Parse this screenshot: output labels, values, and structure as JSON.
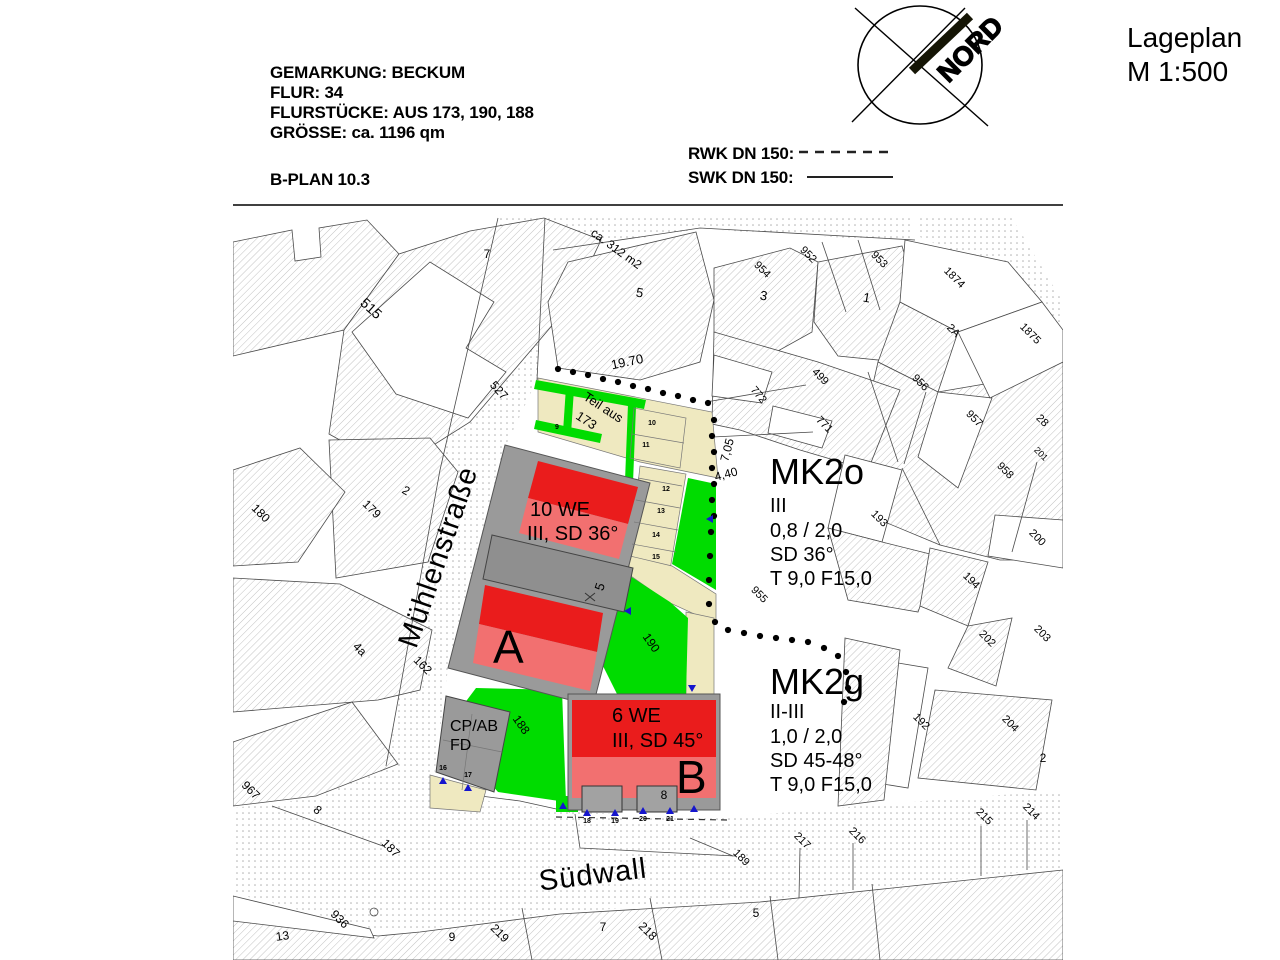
{
  "title": {
    "line1": "Lageplan",
    "line2": "M 1:500"
  },
  "header": {
    "lines": [
      "GEMARKUNG: BECKUM",
      "FLUR: 34",
      "FLURSTÜCKE: AUS 173, 190, 188",
      "GRÖSSE: ca. 1196 qm"
    ],
    "bplan": "B-PLAN 10.3"
  },
  "legend": {
    "rwk_label": "RWK DN 150:",
    "swk_label": "SWK DN 150:"
  },
  "north": {
    "label": "NORD"
  },
  "zones": {
    "mk2o": {
      "name": "MK2o",
      "lines": [
        "III",
        "0,8 / 2,0",
        "SD 36°",
        "T 9,0 F15,0"
      ]
    },
    "mk2g": {
      "name": "MK2g",
      "lines": [
        "II-III",
        "1,0 / 2,0",
        "SD 45-48°",
        "T 9,0 F15,0"
      ]
    }
  },
  "buildings": {
    "a": {
      "label": "A",
      "info1": "10 WE",
      "info2": "III, SD 36°"
    },
    "b": {
      "label": "B",
      "info1": "6 WE",
      "info2": "III, SD 45°"
    },
    "cp": {
      "line1": "CP/AB",
      "line2": "FD"
    }
  },
  "streets": {
    "west": "Mühlenstraße",
    "south": "Südwall"
  },
  "colors": {
    "roof_dark": "#ea1c1c",
    "roof_light": "#f27070",
    "lawn_green": "#00dc00",
    "path_beige": "#efe9c0",
    "building_gray": "#9a9a9a",
    "marker_blue": "#1515cd"
  },
  "map_labels": [
    {
      "t": "515",
      "x": 368,
      "y": 312,
      "r": 42,
      "s": 14
    },
    {
      "t": "7",
      "x": 487,
      "y": 258,
      "r": 0,
      "s": 12
    },
    {
      "t": "527",
      "x": 496,
      "y": 393,
      "r": 48,
      "s": 12
    },
    {
      "t": "2",
      "x": 404,
      "y": 494,
      "r": 30,
      "s": 12
    },
    {
      "t": "179",
      "x": 369,
      "y": 512,
      "r": 45,
      "s": 12
    },
    {
      "t": "180",
      "x": 258,
      "y": 516,
      "r": 45,
      "s": 12
    },
    {
      "t": "4a",
      "x": 357,
      "y": 652,
      "r": 45,
      "s": 12
    },
    {
      "t": "162",
      "x": 420,
      "y": 668,
      "r": 45,
      "s": 12
    },
    {
      "t": "967",
      "x": 248,
      "y": 793,
      "r": 45,
      "s": 12
    },
    {
      "t": "8",
      "x": 315,
      "y": 813,
      "r": 40,
      "s": 12
    },
    {
      "t": "187",
      "x": 388,
      "y": 851,
      "r": 45,
      "s": 12
    },
    {
      "t": "936",
      "x": 337,
      "y": 922,
      "r": 45,
      "s": 12
    },
    {
      "t": "13",
      "x": 283,
      "y": 940,
      "r": -8,
      "s": 12
    },
    {
      "t": "9",
      "x": 452,
      "y": 941,
      "r": 0,
      "s": 12
    },
    {
      "t": "219",
      "x": 497,
      "y": 936,
      "r": 45,
      "s": 12
    },
    {
      "t": "7",
      "x": 603,
      "y": 931,
      "r": 0,
      "s": 12
    },
    {
      "t": "218",
      "x": 645,
      "y": 934,
      "r": 45,
      "s": 12
    },
    {
      "t": "5",
      "x": 756,
      "y": 917,
      "r": 0,
      "s": 12
    },
    {
      "t": "ca. 312 m2",
      "x": 614,
      "y": 252,
      "r": 36,
      "s": 12
    },
    {
      "t": "5",
      "x": 639,
      "y": 297,
      "r": 10,
      "s": 13
    },
    {
      "t": "3",
      "x": 763,
      "y": 300,
      "r": 10,
      "s": 13
    },
    {
      "t": "1",
      "x": 866,
      "y": 302,
      "r": 10,
      "s": 13
    },
    {
      "t": "954",
      "x": 760,
      "y": 272,
      "r": 45,
      "s": 11
    },
    {
      "t": "952",
      "x": 806,
      "y": 257,
      "r": 45,
      "s": 11
    },
    {
      "t": "953",
      "x": 877,
      "y": 262,
      "r": 45,
      "s": 11
    },
    {
      "t": "499",
      "x": 818,
      "y": 379,
      "r": 45,
      "s": 11
    },
    {
      "t": "772",
      "x": 756,
      "y": 397,
      "r": 50,
      "s": 11
    },
    {
      "t": "771",
      "x": 822,
      "y": 427,
      "r": 45,
      "s": 11
    },
    {
      "t": "1874",
      "x": 952,
      "y": 280,
      "r": 45,
      "s": 11
    },
    {
      "t": "2A",
      "x": 951,
      "y": 333,
      "r": 45,
      "s": 11
    },
    {
      "t": "1875",
      "x": 1028,
      "y": 336,
      "r": 45,
      "s": 11
    },
    {
      "t": "956",
      "x": 918,
      "y": 385,
      "r": 45,
      "s": 11
    },
    {
      "t": "957",
      "x": 972,
      "y": 421,
      "r": 45,
      "s": 11
    },
    {
      "t": "28",
      "x": 1040,
      "y": 423,
      "r": 45,
      "s": 11
    },
    {
      "t": "201",
      "x": 1039,
      "y": 456,
      "r": 45,
      "s": 9
    },
    {
      "t": "958",
      "x": 1003,
      "y": 473,
      "r": 45,
      "s": 11
    },
    {
      "t": "200",
      "x": 1035,
      "y": 540,
      "r": 45,
      "s": 11
    },
    {
      "t": "193",
      "x": 877,
      "y": 521,
      "r": 45,
      "s": 11
    },
    {
      "t": "955",
      "x": 757,
      "y": 597,
      "r": 45,
      "s": 11
    },
    {
      "t": "194",
      "x": 969,
      "y": 583,
      "r": 45,
      "s": 11
    },
    {
      "t": "202",
      "x": 985,
      "y": 641,
      "r": 45,
      "s": 11
    },
    {
      "t": "203",
      "x": 1040,
      "y": 636,
      "r": 45,
      "s": 11
    },
    {
      "t": "192",
      "x": 919,
      "y": 724,
      "r": 45,
      "s": 11
    },
    {
      "t": "204",
      "x": 1008,
      "y": 726,
      "r": 45,
      "s": 11
    },
    {
      "t": "2",
      "x": 1043,
      "y": 762,
      "r": 0,
      "s": 12
    },
    {
      "t": "215",
      "x": 982,
      "y": 819,
      "r": 45,
      "s": 11
    },
    {
      "t": "214",
      "x": 1029,
      "y": 814,
      "r": 45,
      "s": 11
    },
    {
      "t": "216",
      "x": 855,
      "y": 838,
      "r": 45,
      "s": 11
    },
    {
      "t": "217",
      "x": 800,
      "y": 843,
      "r": 45,
      "s": 11
    },
    {
      "t": "189",
      "x": 739,
      "y": 860,
      "r": 45,
      "s": 11
    },
    {
      "t": "190",
      "x": 648,
      "y": 645,
      "r": 55,
      "s": 12
    },
    {
      "t": "188",
      "x": 518,
      "y": 727,
      "r": 55,
      "s": 12
    },
    {
      "t": "Teil aus",
      "x": 601,
      "y": 411,
      "r": 33,
      "s": 13
    },
    {
      "t": "173",
      "x": 584,
      "y": 424,
      "r": 33,
      "s": 13
    },
    {
      "t": "19.70",
      "x": 628,
      "y": 366,
      "r": -12,
      "s": 13
    },
    {
      "t": "7,05",
      "x": 731,
      "y": 451,
      "r": -75,
      "s": 12
    },
    {
      "t": "4,40",
      "x": 727,
      "y": 478,
      "r": -15,
      "s": 12
    },
    {
      "t": "5",
      "x": 604,
      "y": 588,
      "r": -72,
      "s": 13
    },
    {
      "t": "8",
      "x": 664,
      "y": 799,
      "r": 0,
      "s": 12
    },
    {
      "t": "9",
      "x": 557,
      "y": 429,
      "r": 0,
      "s": 7,
      "b": 1
    },
    {
      "t": "10",
      "x": 652,
      "y": 425,
      "r": 0,
      "s": 7,
      "b": 1
    },
    {
      "t": "11",
      "x": 646,
      "y": 447,
      "r": 0,
      "s": 7,
      "b": 1
    },
    {
      "t": "12",
      "x": 666,
      "y": 491,
      "r": 0,
      "s": 7,
      "b": 1
    },
    {
      "t": "13",
      "x": 661,
      "y": 513,
      "r": 0,
      "s": 7,
      "b": 1
    },
    {
      "t": "14",
      "x": 656,
      "y": 537,
      "r": 0,
      "s": 7,
      "b": 1
    },
    {
      "t": "15",
      "x": 656,
      "y": 559,
      "r": 0,
      "s": 7,
      "b": 1
    },
    {
      "t": "16",
      "x": 443,
      "y": 770,
      "r": 0,
      "s": 7,
      "b": 1
    },
    {
      "t": "17",
      "x": 468,
      "y": 777,
      "r": 0,
      "s": 7,
      "b": 1
    },
    {
      "t": "18",
      "x": 587,
      "y": 823,
      "r": 0,
      "s": 7,
      "b": 1
    },
    {
      "t": "19",
      "x": 615,
      "y": 823,
      "r": 0,
      "s": 7,
      "b": 1
    },
    {
      "t": "20",
      "x": 643,
      "y": 821,
      "r": 0,
      "s": 7,
      "b": 1
    },
    {
      "t": "21",
      "x": 670,
      "y": 821,
      "r": 0,
      "s": 7,
      "b": 1
    }
  ],
  "boundary_dots": [
    [
      558,
      369
    ],
    [
      573,
      372
    ],
    [
      588,
      375
    ],
    [
      603,
      379
    ],
    [
      618,
      382
    ],
    [
      633,
      386
    ],
    [
      648,
      389
    ],
    [
      663,
      393
    ],
    [
      678,
      396
    ],
    [
      693,
      400
    ],
    [
      708,
      403
    ],
    [
      714,
      420
    ],
    [
      712,
      436
    ],
    [
      714,
      452
    ],
    [
      712,
      468
    ],
    [
      714,
      484
    ],
    [
      712,
      500
    ],
    [
      714,
      516
    ],
    [
      711,
      532
    ],
    [
      710,
      556
    ],
    [
      709,
      580
    ],
    [
      709,
      604
    ],
    [
      715,
      622
    ],
    [
      728,
      630
    ],
    [
      744,
      633
    ],
    [
      760,
      636
    ],
    [
      776,
      638
    ],
    [
      792,
      640
    ],
    [
      808,
      642
    ],
    [
      824,
      648
    ],
    [
      838,
      656
    ],
    [
      846,
      672
    ],
    [
      848,
      688
    ],
    [
      844,
      702
    ]
  ],
  "markers": [
    {
      "x": 563,
      "y": 806,
      "d": "up"
    },
    {
      "x": 587,
      "y": 813,
      "d": "up"
    },
    {
      "x": 615,
      "y": 813,
      "d": "up"
    },
    {
      "x": 643,
      "y": 811,
      "d": "up"
    },
    {
      "x": 670,
      "y": 811,
      "d": "up"
    },
    {
      "x": 694,
      "y": 809,
      "d": "up"
    },
    {
      "x": 443,
      "y": 781,
      "d": "up"
    },
    {
      "x": 468,
      "y": 788,
      "d": "up"
    },
    {
      "x": 692,
      "y": 688,
      "d": "down"
    },
    {
      "x": 628,
      "y": 611,
      "d": "left"
    },
    {
      "x": 710,
      "y": 519,
      "d": "left"
    }
  ]
}
